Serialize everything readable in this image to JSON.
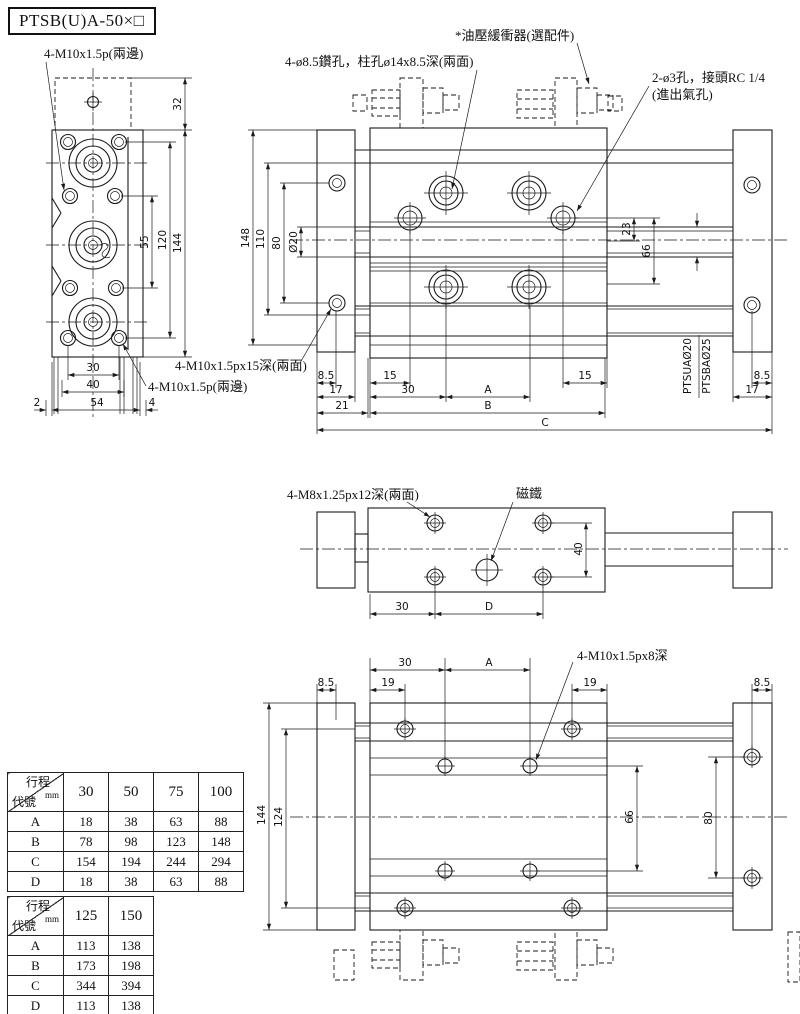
{
  "title": "PTSB(U)A-50×□",
  "annotations": {
    "thread_top": "4-M10x1.5p(兩邊)",
    "drill": "4-ø8.5鑽孔，柱孔ø14x8.5深(兩面)",
    "shock": "*油壓緩衝器(選配件)",
    "port1": "2-ø3孔，接頭RC 1/4",
    "port2": "(進出氣孔)",
    "tap15": "4-M10x1.5px15深(兩面)",
    "thread_bottom": "4-M10x1.5p(兩邊)",
    "tap_m8": "4-M8x1.25px12深(兩面)",
    "magnet": "磁鐵",
    "tap8": "4-M10x1.5px8深",
    "rod_u": "PTSUAØ20",
    "rod_b": "PTSBAØ25"
  },
  "d": {
    "v2": "2",
    "v4": "4",
    "v8_5": "8.5",
    "v15": "15",
    "v17": "17",
    "v19": "19",
    "v21": "21",
    "v23": "23",
    "v30": "30",
    "v32": "32",
    "v40": "40",
    "v54": "54",
    "v55": "55",
    "v66": "66",
    "v80": "80",
    "v110": "110",
    "v120": "120",
    "v124": "124",
    "v144": "144",
    "v148": "148",
    "dia20": "Ø20",
    "A": "A",
    "B": "B",
    "C": "C",
    "D": "D"
  },
  "tables": [
    {
      "header_top": "行程",
      "header_unit": "mm",
      "header_bottom": "代號",
      "columns": [
        "30",
        "50",
        "75",
        "100"
      ],
      "rows": [
        {
          "label": "A",
          "values": [
            "18",
            "38",
            "63",
            "88"
          ]
        },
        {
          "label": "B",
          "values": [
            "78",
            "98",
            "123",
            "148"
          ]
        },
        {
          "label": "C",
          "values": [
            "154",
            "194",
            "244",
            "294"
          ]
        },
        {
          "label": "D",
          "values": [
            "18",
            "38",
            "63",
            "88"
          ]
        }
      ]
    },
    {
      "header_top": "行程",
      "header_unit": "mm",
      "header_bottom": "代號",
      "columns": [
        "125",
        "150"
      ],
      "rows": [
        {
          "label": "A",
          "values": [
            "113",
            "138"
          ]
        },
        {
          "label": "B",
          "values": [
            "173",
            "198"
          ]
        },
        {
          "label": "C",
          "values": [
            "344",
            "394"
          ]
        },
        {
          "label": "D",
          "values": [
            "113",
            "138"
          ]
        }
      ]
    }
  ]
}
